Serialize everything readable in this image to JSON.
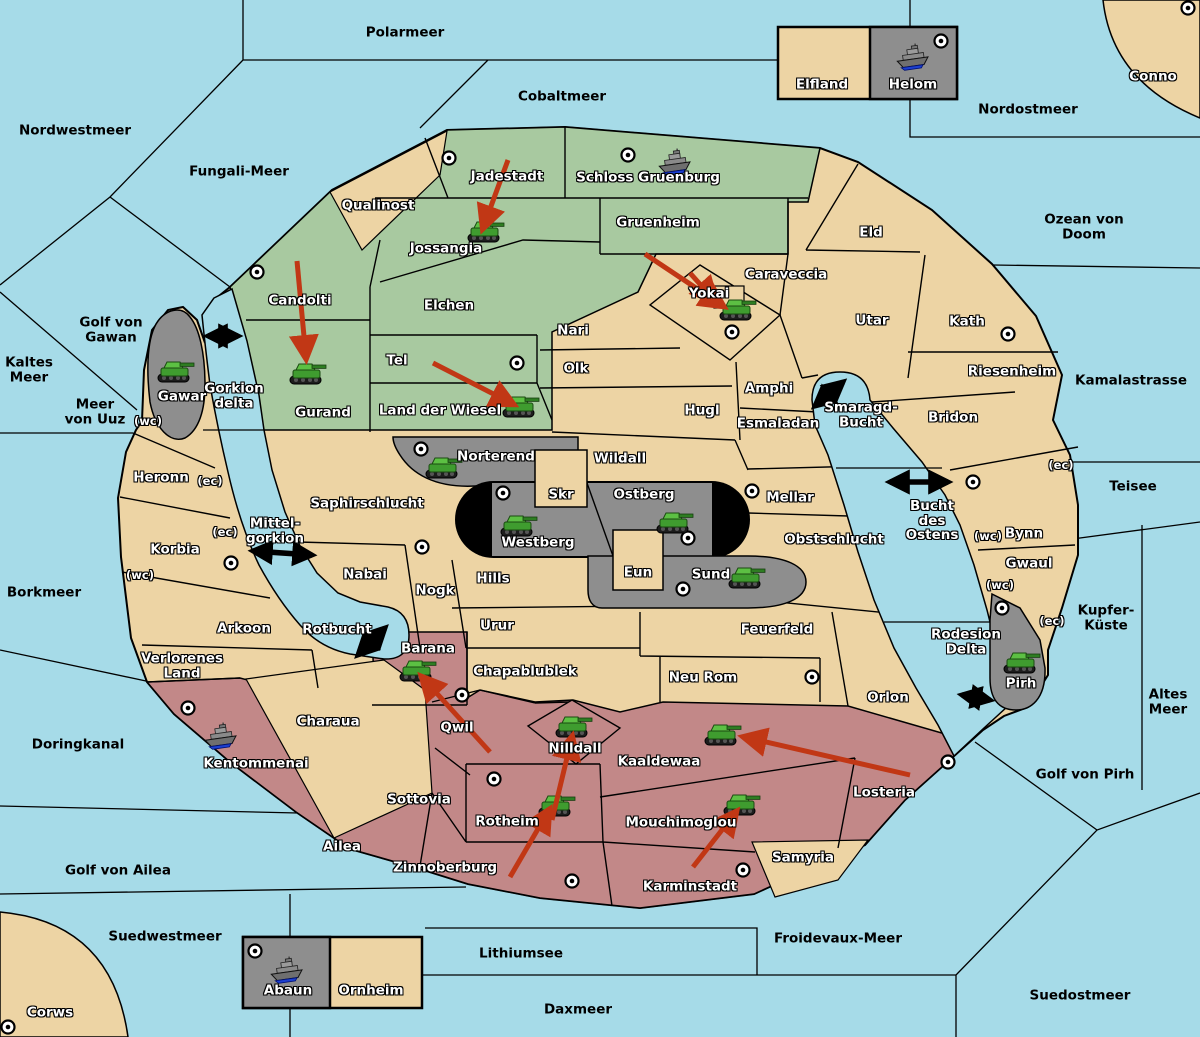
{
  "map": {
    "colors": {
      "water": "#A6DBE8",
      "land": "#EDD4A4",
      "green_region": "#A8C9A0",
      "red_region": "#C28888",
      "gray_region": "#8E8E8E",
      "border": "#000000",
      "attack_arrow": "#C13715",
      "tank_green": "#4CAE3B",
      "ship_gray": "#8A8A8A",
      "ship_stripe": "#1C3FD0"
    },
    "labels": [
      {
        "text": "Polarmeer",
        "x": 405,
        "y": 33,
        "kind": "sea"
      },
      {
        "text": "Cobaltmeer",
        "x": 562,
        "y": 97,
        "kind": "sea"
      },
      {
        "text": "Nordostmeer",
        "x": 1028,
        "y": 110,
        "kind": "sea"
      },
      {
        "text": "Nordwestmeer",
        "x": 75,
        "y": 131,
        "kind": "sea"
      },
      {
        "text": "Fungali-Meer",
        "x": 239,
        "y": 172,
        "kind": "sea"
      },
      {
        "text": "Ozean von Doom",
        "x": 1084,
        "y": 227,
        "kind": "sea"
      },
      {
        "text": "Kaltes\nMeer",
        "x": 29,
        "y": 370,
        "kind": "sea"
      },
      {
        "text": "Golf von\nGawan",
        "x": 111,
        "y": 330,
        "kind": "sea"
      },
      {
        "text": "Meer\nvon Uuz",
        "x": 95,
        "y": 412,
        "kind": "sea"
      },
      {
        "text": "Kamalastrasse",
        "x": 1131,
        "y": 381,
        "kind": "sea"
      },
      {
        "text": "Teisee",
        "x": 1133,
        "y": 487,
        "kind": "sea"
      },
      {
        "text": "Borkmeer",
        "x": 44,
        "y": 593,
        "kind": "sea"
      },
      {
        "text": "Kupfer-\nKüste",
        "x": 1106,
        "y": 618,
        "kind": "sea"
      },
      {
        "text": "Altes\nMeer",
        "x": 1168,
        "y": 702,
        "kind": "sea"
      },
      {
        "text": "Golf von Pirh",
        "x": 1085,
        "y": 775,
        "kind": "sea"
      },
      {
        "text": "Doringkanal",
        "x": 78,
        "y": 745,
        "kind": "sea"
      },
      {
        "text": "Golf von Ailea",
        "x": 118,
        "y": 871,
        "kind": "sea"
      },
      {
        "text": "Suedwestmeer",
        "x": 165,
        "y": 937,
        "kind": "sea"
      },
      {
        "text": "Froidevaux-Meer",
        "x": 838,
        "y": 939,
        "kind": "sea"
      },
      {
        "text": "Suedostmeer",
        "x": 1080,
        "y": 996,
        "kind": "sea"
      },
      {
        "text": "Lithiumsee",
        "x": 521,
        "y": 954,
        "kind": "sea"
      },
      {
        "text": "Daxmeer",
        "x": 578,
        "y": 1010,
        "kind": "sea"
      },
      {
        "text": "Qualinost",
        "x": 378,
        "y": 206,
        "kind": "territory"
      },
      {
        "text": "Jadestadt",
        "x": 507,
        "y": 177,
        "kind": "territory"
      },
      {
        "text": "Schloss Gruenburg",
        "x": 648,
        "y": 178,
        "kind": "territory"
      },
      {
        "text": "Jossangia",
        "x": 446,
        "y": 249,
        "kind": "territory"
      },
      {
        "text": "Gruenheim",
        "x": 658,
        "y": 223,
        "kind": "territory"
      },
      {
        "text": "Candolti",
        "x": 300,
        "y": 301,
        "kind": "territory"
      },
      {
        "text": "Elchen",
        "x": 449,
        "y": 306,
        "kind": "territory"
      },
      {
        "text": "Yokai",
        "x": 709,
        "y": 294,
        "kind": "territory"
      },
      {
        "text": "Caraveccia",
        "x": 786,
        "y": 275,
        "kind": "territory"
      },
      {
        "text": "Nari",
        "x": 573,
        "y": 331,
        "kind": "territory"
      },
      {
        "text": "Olk",
        "x": 576,
        "y": 369,
        "kind": "territory"
      },
      {
        "text": "Tel",
        "x": 397,
        "y": 361,
        "kind": "territory"
      },
      {
        "text": "Land der Wiesel",
        "x": 440,
        "y": 411,
        "kind": "territory"
      },
      {
        "text": "Gurand",
        "x": 323,
        "y": 413,
        "kind": "territory"
      },
      {
        "text": "Gawar",
        "x": 182,
        "y": 397,
        "kind": "territory"
      },
      {
        "text": "Gorkion\ndelta",
        "x": 234,
        "y": 396,
        "kind": "territory"
      },
      {
        "text": "Eld",
        "x": 871,
        "y": 233,
        "kind": "territory"
      },
      {
        "text": "Utar",
        "x": 872,
        "y": 321,
        "kind": "territory"
      },
      {
        "text": "Kath",
        "x": 967,
        "y": 322,
        "kind": "territory"
      },
      {
        "text": "Riesenheim",
        "x": 1012,
        "y": 372,
        "kind": "territory"
      },
      {
        "text": "Amphi",
        "x": 769,
        "y": 389,
        "kind": "territory"
      },
      {
        "text": "Hugl",
        "x": 702,
        "y": 411,
        "kind": "territory"
      },
      {
        "text": "Esmaladan",
        "x": 778,
        "y": 424,
        "kind": "territory"
      },
      {
        "text": "Bridon",
        "x": 953,
        "y": 418,
        "kind": "territory"
      },
      {
        "text": "Smaragd-\nBucht",
        "x": 861,
        "y": 415,
        "kind": "territory"
      },
      {
        "text": "Norterend",
        "x": 496,
        "y": 457,
        "kind": "territory"
      },
      {
        "text": "Wildall",
        "x": 620,
        "y": 459,
        "kind": "territory"
      },
      {
        "text": "Skr",
        "x": 561,
        "y": 495,
        "kind": "territory"
      },
      {
        "text": "Ostberg",
        "x": 644,
        "y": 495,
        "kind": "territory"
      },
      {
        "text": "Mellar",
        "x": 790,
        "y": 498,
        "kind": "territory"
      },
      {
        "text": "Westberg",
        "x": 538,
        "y": 543,
        "kind": "territory"
      },
      {
        "text": "Obstschlucht",
        "x": 834,
        "y": 540,
        "kind": "territory"
      },
      {
        "text": "Bucht\ndes\nOstens",
        "x": 932,
        "y": 521,
        "kind": "territory"
      },
      {
        "text": "Bynn",
        "x": 1024,
        "y": 534,
        "kind": "territory"
      },
      {
        "text": "Gwaul",
        "x": 1029,
        "y": 564,
        "kind": "territory"
      },
      {
        "text": "Heronn",
        "x": 161,
        "y": 478,
        "kind": "territory"
      },
      {
        "text": "Saphirschlucht",
        "x": 367,
        "y": 504,
        "kind": "territory"
      },
      {
        "text": "Korbia",
        "x": 175,
        "y": 550,
        "kind": "territory"
      },
      {
        "text": "Mittel-\ngorkion",
        "x": 275,
        "y": 531,
        "kind": "territory"
      },
      {
        "text": "Nabai",
        "x": 365,
        "y": 575,
        "kind": "territory"
      },
      {
        "text": "Nogk",
        "x": 435,
        "y": 591,
        "kind": "territory"
      },
      {
        "text": "Hills",
        "x": 493,
        "y": 579,
        "kind": "territory"
      },
      {
        "text": "Eun",
        "x": 638,
        "y": 573,
        "kind": "territory"
      },
      {
        "text": "Sund",
        "x": 711,
        "y": 575,
        "kind": "territory"
      },
      {
        "text": "Urur",
        "x": 497,
        "y": 626,
        "kind": "territory"
      },
      {
        "text": "Feuerfeld",
        "x": 777,
        "y": 630,
        "kind": "territory"
      },
      {
        "text": "Rotbucht",
        "x": 337,
        "y": 630,
        "kind": "territory"
      },
      {
        "text": "Arkoon",
        "x": 244,
        "y": 629,
        "kind": "territory"
      },
      {
        "text": "Barana",
        "x": 428,
        "y": 649,
        "kind": "territory"
      },
      {
        "text": "Chapablublek",
        "x": 525,
        "y": 672,
        "kind": "territory"
      },
      {
        "text": "Neu Rom",
        "x": 703,
        "y": 678,
        "kind": "territory"
      },
      {
        "text": "Orlon",
        "x": 888,
        "y": 698,
        "kind": "territory"
      },
      {
        "text": "Rodesion\nDelta",
        "x": 966,
        "y": 642,
        "kind": "territory"
      },
      {
        "text": "Pirh",
        "x": 1021,
        "y": 684,
        "kind": "territory"
      },
      {
        "text": "Verlorenes\nLand",
        "x": 182,
        "y": 666,
        "kind": "territory"
      },
      {
        "text": "Charaua",
        "x": 328,
        "y": 722,
        "kind": "territory"
      },
      {
        "text": "Qwil",
        "x": 457,
        "y": 728,
        "kind": "territory"
      },
      {
        "text": "Kentommenai",
        "x": 256,
        "y": 764,
        "kind": "territory"
      },
      {
        "text": "Nilldall",
        "x": 575,
        "y": 749,
        "kind": "territory"
      },
      {
        "text": "Kaaldewaa",
        "x": 659,
        "y": 762,
        "kind": "territory"
      },
      {
        "text": "Losteria",
        "x": 884,
        "y": 793,
        "kind": "territory"
      },
      {
        "text": "Sottovia",
        "x": 419,
        "y": 800,
        "kind": "territory"
      },
      {
        "text": "Rotheim",
        "x": 507,
        "y": 822,
        "kind": "territory"
      },
      {
        "text": "Mouchimoglou",
        "x": 681,
        "y": 823,
        "kind": "territory"
      },
      {
        "text": "Samyria",
        "x": 803,
        "y": 858,
        "kind": "territory"
      },
      {
        "text": "Ailea",
        "x": 342,
        "y": 847,
        "kind": "territory"
      },
      {
        "text": "Zinnoberburg",
        "x": 445,
        "y": 868,
        "kind": "territory"
      },
      {
        "text": "Karminstadt",
        "x": 690,
        "y": 887,
        "kind": "territory"
      },
      {
        "text": "Elfland",
        "x": 822,
        "y": 85,
        "kind": "territory"
      },
      {
        "text": "Helom",
        "x": 913,
        "y": 85,
        "kind": "territory"
      },
      {
        "text": "Abaun",
        "x": 288,
        "y": 991,
        "kind": "territory"
      },
      {
        "text": "Ornheim",
        "x": 371,
        "y": 991,
        "kind": "territory"
      },
      {
        "text": "Corws",
        "x": 50,
        "y": 1013,
        "kind": "territory"
      },
      {
        "text": "Conno",
        "x": 1153,
        "y": 77,
        "kind": "territory"
      },
      {
        "text": "(wc)",
        "x": 148,
        "y": 421,
        "kind": "coast-code"
      },
      {
        "text": "(ec)",
        "x": 210,
        "y": 481,
        "kind": "coast-code"
      },
      {
        "text": "(ec)",
        "x": 225,
        "y": 532,
        "kind": "coast-code"
      },
      {
        "text": "(wc)",
        "x": 140,
        "y": 575,
        "kind": "coast-code"
      },
      {
        "text": "(ec)",
        "x": 1061,
        "y": 465,
        "kind": "coast-code"
      },
      {
        "text": "(wc)",
        "x": 988,
        "y": 536,
        "kind": "coast-code"
      },
      {
        "text": "(wc)",
        "x": 1000,
        "y": 585,
        "kind": "coast-code"
      },
      {
        "text": "(ec)",
        "x": 1052,
        "y": 621,
        "kind": "coast-code"
      }
    ],
    "city_markers": [
      [
        449,
        158
      ],
      [
        628,
        155
      ],
      [
        941,
        41
      ],
      [
        1188,
        8
      ],
      [
        257,
        272
      ],
      [
        517,
        363
      ],
      [
        421,
        449
      ],
      [
        503,
        493
      ],
      [
        752,
        491
      ],
      [
        688,
        538
      ],
      [
        683,
        589
      ],
      [
        732,
        332
      ],
      [
        973,
        482
      ],
      [
        1008,
        334
      ],
      [
        1002,
        608
      ],
      [
        231,
        563
      ],
      [
        422,
        547
      ],
      [
        188,
        708
      ],
      [
        462,
        695
      ],
      [
        494,
        779
      ],
      [
        572,
        881
      ],
      [
        743,
        870
      ],
      [
        948,
        762
      ],
      [
        812,
        677
      ],
      [
        255,
        951
      ],
      [
        8,
        1027
      ]
    ],
    "units": {
      "tanks": [
        [
          485,
          232
        ],
        [
          737,
          310
        ],
        [
          307,
          374
        ],
        [
          175,
          372
        ],
        [
          520,
          407
        ],
        [
          443,
          468
        ],
        [
          518,
          526
        ],
        [
          674,
          523
        ],
        [
          746,
          578
        ],
        [
          1021,
          663
        ],
        [
          417,
          671
        ],
        [
          573,
          727
        ],
        [
          722,
          735
        ],
        [
          556,
          806
        ],
        [
          741,
          805
        ]
      ],
      "ships": [
        [
          675,
          163
        ],
        [
          913,
          58
        ],
        [
          221,
          737
        ],
        [
          287,
          971
        ]
      ]
    },
    "transport_links": [
      [
        208,
        336,
        238,
        336
      ],
      [
        815,
        406,
        843,
        382
      ],
      [
        890,
        482,
        948,
        482
      ],
      [
        253,
        551,
        312,
        555
      ],
      [
        358,
        655,
        385,
        628
      ],
      [
        962,
        695,
        990,
        700
      ]
    ],
    "attack_arrows": [
      [
        508,
        160,
        483,
        228
      ],
      [
        645,
        254,
        723,
        306
      ],
      [
        690,
        273,
        715,
        301
      ],
      [
        297,
        261,
        306,
        358
      ],
      [
        433,
        363,
        513,
        404
      ],
      [
        510,
        877,
        549,
        810
      ],
      [
        552,
        820,
        572,
        737
      ],
      [
        693,
        867,
        736,
        812
      ],
      [
        910,
        775,
        744,
        737
      ],
      [
        490,
        752,
        422,
        677
      ]
    ]
  }
}
